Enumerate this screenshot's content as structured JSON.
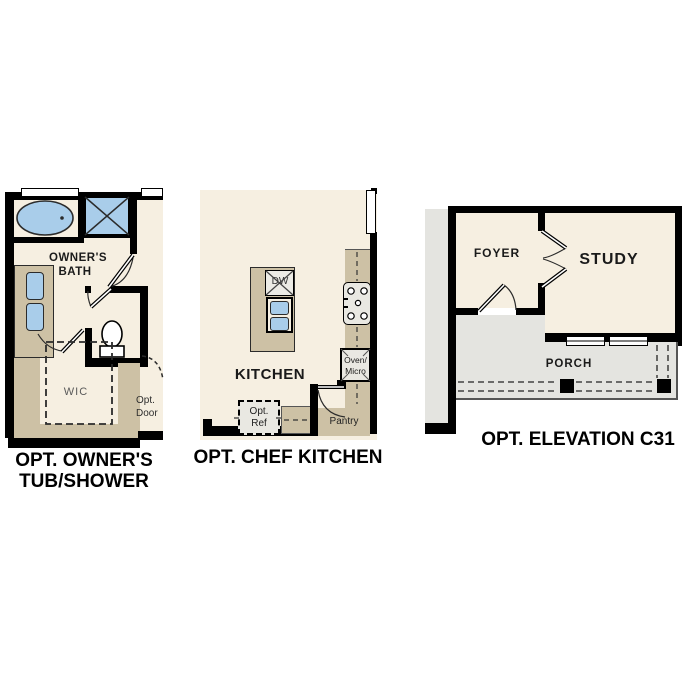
{
  "plans": {
    "tub_shower": {
      "caption_line1": "OPT. OWNER'S",
      "caption_line2": "TUB/SHOWER",
      "room_label_line1": "OWNER'S",
      "room_label_line2": "BATH",
      "wic_label": "WIC",
      "opt_door_line1": "Opt.",
      "opt_door_line2": "Door"
    },
    "chef_kitchen": {
      "caption": "OPT. CHEF KITCHEN",
      "kitchen_label": "KITCHEN",
      "dw_label": "DW",
      "oven_micro_line1": "Oven/",
      "oven_micro_line2": "Micro",
      "opt_ref_line1": "Opt.",
      "opt_ref_line2": "Ref",
      "pantry_label": "Pantry"
    },
    "elevation_c31": {
      "caption": "OPT. ELEVATION C31",
      "foyer_label": "FOYER",
      "study_label": "STUDY",
      "porch_label": "PORCH"
    }
  },
  "colors": {
    "wall": "#000000",
    "floor": "#f6efe1",
    "cabinet": "#cdc1a5",
    "fixture": "#a9cdea",
    "porch": "#e4e4e0",
    "appliance": "#e9e8e2",
    "label_muted": "#5a5a5a"
  }
}
